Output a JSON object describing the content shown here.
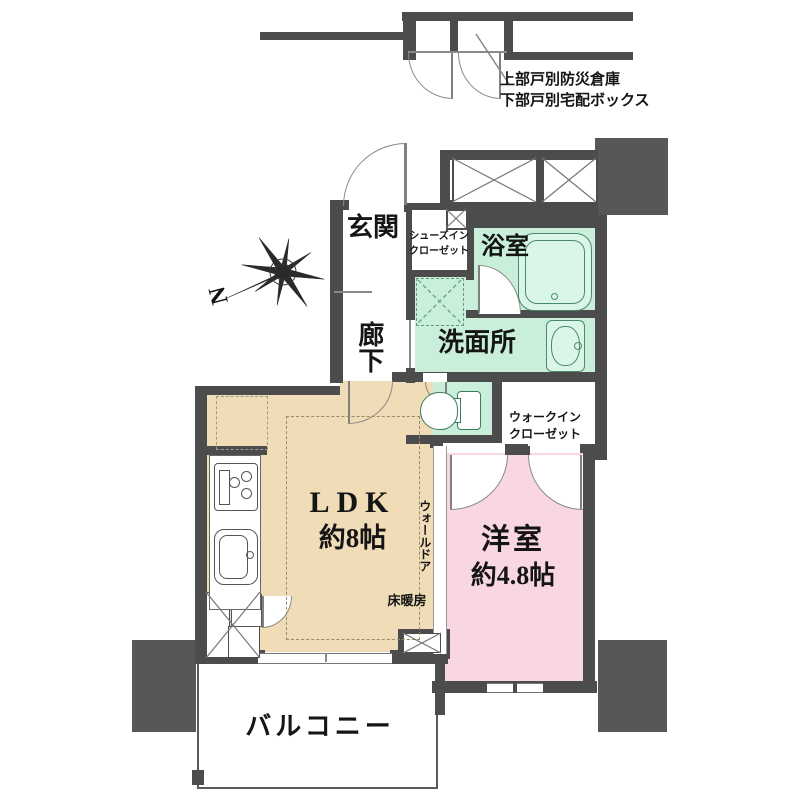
{
  "type": "floorplan",
  "colors": {
    "wall": "#4c4c4c",
    "block": "#575757",
    "ldk": "#f0dcb6",
    "bedroom": "#f9d7e2",
    "wet": "#c9efdb",
    "fixture": "#4a8a6a"
  },
  "labels": {
    "storage_note_line1": "上部戸別防災倉庫",
    "storage_note_line2": "下部戸別宅配ボックス",
    "genkan": "玄関",
    "sic_line1": "シューズイン",
    "sic_line2": "クローゼット",
    "bathroom": "浴室",
    "hallway": "廊下",
    "washroom": "洗面所",
    "wic_line1": "ウォークイン",
    "wic_line2": "クローゼット",
    "ldk_line1": "LDK",
    "ldk_line2": "約8帖",
    "wall_door": "ウォールドア",
    "floor_heating": "床暖房",
    "bedroom_line1": "洋室",
    "bedroom_line2": "約4.8帖",
    "balcony": "バルコニー",
    "compass_north": "N"
  }
}
